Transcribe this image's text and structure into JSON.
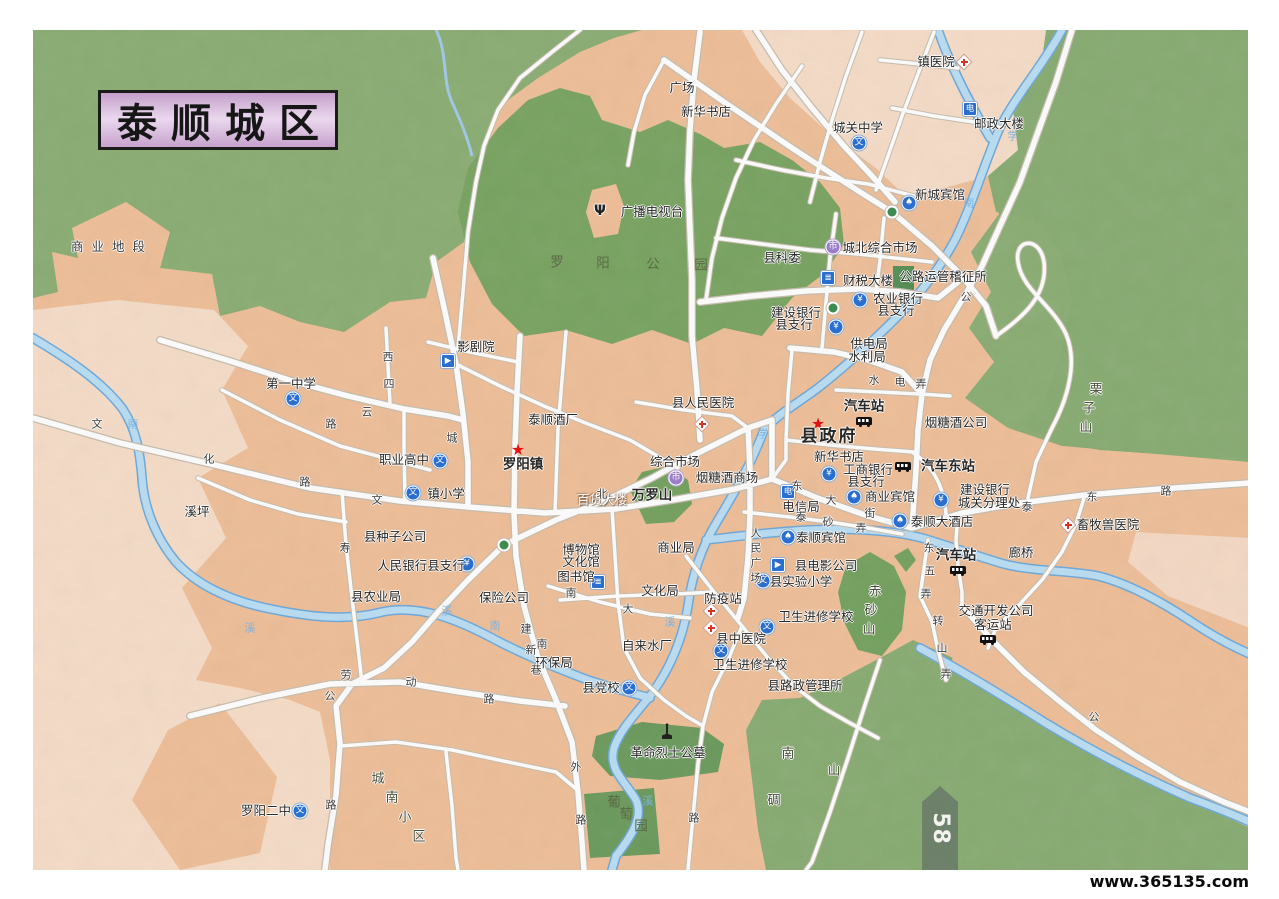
{
  "page": {
    "title": "泰顺城区",
    "page_number": "58",
    "watermark": "www.365135.com"
  },
  "colors": {
    "hills_green": "#87ab6f",
    "park_green": "#74a15c",
    "urban_salmon": "#efbd95",
    "urban_pale": "#f6dcc6",
    "river_blue": "#b8ddf4",
    "river_edge": "#6aa6d8",
    "road_white": "#ffffff",
    "road_casing": "#c6bcab",
    "icon_blue": "#2a6fd0",
    "title_purple": "#d5b3da",
    "star_red": "#e01010"
  },
  "map": {
    "icon_glyphs": {
      "school": "文",
      "bank": "¥",
      "hotel": "♠",
      "market": "市",
      "postal": "电",
      "book": "≣",
      "cinema": "▶",
      "antenna": "Ψ",
      "star": "★"
    },
    "labels": [
      [
        "商业地段",
        112,
        247,
        "a"
      ],
      [
        "广场",
        682,
        88,
        "p"
      ],
      [
        "新华书店",
        706,
        112,
        "p"
      ],
      [
        "镇医院",
        936,
        62,
        "p"
      ],
      [
        "城关中学",
        858,
        128,
        "p"
      ],
      [
        "邮政大楼",
        999,
        124,
        "p"
      ],
      [
        "新城宾馆",
        940,
        195,
        "p"
      ],
      [
        "城北综合市场",
        880,
        248,
        "p"
      ],
      [
        "县科委",
        782,
        258,
        "p"
      ],
      [
        "财税大楼",
        868,
        281,
        "p"
      ],
      [
        "公路运管稽征所",
        943,
        277,
        "p"
      ],
      [
        "农业银行",
        898,
        299,
        "p"
      ],
      [
        "县支行",
        896,
        311,
        "p"
      ],
      [
        "建设银行",
        796,
        313,
        "p"
      ],
      [
        "县支行",
        794,
        325,
        "p"
      ],
      [
        "供电局",
        869,
        344,
        "p"
      ],
      [
        "水利局",
        867,
        357,
        "p"
      ],
      [
        "汽车站",
        864,
        407,
        "b"
      ],
      [
        "县政府",
        829,
        437,
        "B"
      ],
      [
        "新华书店",
        839,
        457,
        "p"
      ],
      [
        "工商银行",
        868,
        470,
        "p"
      ],
      [
        "县支行",
        866,
        482,
        "p"
      ],
      [
        "商业宾馆",
        890,
        497,
        "p"
      ],
      [
        "电信局",
        801,
        507,
        "p"
      ],
      [
        "泰顺大酒店",
        942,
        522,
        "p"
      ],
      [
        "泰顺宾馆",
        821,
        538,
        "p"
      ],
      [
        "汽车东站",
        948,
        467,
        "b"
      ],
      [
        "建设银行",
        985,
        490,
        "p"
      ],
      [
        "城关分理处",
        989,
        503,
        "p"
      ],
      [
        "烟糖酒公司",
        956,
        423,
        "p"
      ],
      [
        "汽车站",
        956,
        556,
        "b"
      ],
      [
        "廊桥",
        1021,
        553,
        "p"
      ],
      [
        "畜牧兽医院",
        1108,
        525,
        "p"
      ],
      [
        "交通开发公司",
        996,
        611,
        "p"
      ],
      [
        "客运站",
        993,
        625,
        "p"
      ],
      [
        "县电影公司",
        826,
        566,
        "p"
      ],
      [
        "县实验小学",
        801,
        582,
        "p"
      ],
      [
        "卫生进修学校",
        816,
        617,
        "p"
      ],
      [
        "防疫站",
        723,
        599,
        "p"
      ],
      [
        "县中医院",
        741,
        639,
        "p"
      ],
      [
        "卫生进修学校",
        750,
        665,
        "p"
      ],
      [
        "县路政管理所",
        805,
        686,
        "p"
      ],
      [
        "县党校",
        601,
        688,
        "p"
      ],
      [
        "环保局",
        554,
        663,
        "p"
      ],
      [
        "自来水厂",
        647,
        646,
        "p"
      ],
      [
        "文化局",
        660,
        591,
        "p"
      ],
      [
        "图书馆",
        576,
        577,
        "p"
      ],
      [
        "博物馆",
        581,
        550,
        "p"
      ],
      [
        "文化馆",
        581,
        562,
        "p"
      ],
      [
        "商业局",
        676,
        548,
        "p"
      ],
      [
        "保险公司",
        504,
        598,
        "p"
      ],
      [
        "县农业局",
        376,
        597,
        "p"
      ],
      [
        "人民银行县支行",
        421,
        566,
        "p"
      ],
      [
        "县种子公司",
        395,
        537,
        "p"
      ],
      [
        "溪坪",
        197,
        512,
        "p"
      ],
      [
        "镇小学",
        446,
        494,
        "p"
      ],
      [
        "职业高中",
        404,
        460,
        "p"
      ],
      [
        "第一中学",
        291,
        384,
        "p"
      ],
      [
        "影剧院",
        476,
        347,
        "p"
      ],
      [
        "泰顺酒厂",
        553,
        420,
        "p"
      ],
      [
        "罗阳镇",
        523,
        465,
        "b"
      ],
      [
        "县人民医院",
        703,
        403,
        "p"
      ],
      [
        "综合市场",
        675,
        462,
        "p"
      ],
      [
        "烟糖酒商场",
        727,
        478,
        "p"
      ],
      [
        "百货大楼",
        602,
        500,
        "w"
      ],
      [
        "革命烈士公墓",
        668,
        753,
        "p"
      ],
      [
        "罗阳二中",
        266,
        811,
        "p"
      ],
      [
        "广播电视台",
        652,
        212,
        "p"
      ],
      [
        "万罗山",
        652,
        496,
        "b"
      ],
      [
        "赤",
        875,
        592,
        "m"
      ],
      [
        "砂",
        871,
        611,
        "m"
      ],
      [
        "山",
        869,
        630,
        "m"
      ],
      [
        "栗",
        1096,
        390,
        "m"
      ],
      [
        "子",
        1089,
        409,
        "m"
      ],
      [
        "山",
        1086,
        428,
        "m"
      ],
      [
        "南",
        788,
        754,
        "m"
      ],
      [
        "山",
        834,
        771,
        "m"
      ],
      [
        "碉",
        774,
        801,
        "m"
      ],
      [
        "城",
        378,
        779,
        "m"
      ],
      [
        "南",
        392,
        798,
        "m"
      ],
      [
        "小",
        405,
        818,
        "m"
      ],
      [
        "区",
        419,
        837,
        "m"
      ],
      [
        "罗",
        557,
        263,
        "g"
      ],
      [
        "阳",
        603,
        264,
        "g"
      ],
      [
        "公",
        653,
        265,
        "g"
      ],
      [
        "园",
        701,
        266,
        "g"
      ],
      [
        "葡",
        614,
        803,
        "g"
      ],
      [
        "萄",
        626,
        815,
        "g"
      ],
      [
        "园",
        641,
        827,
        "g"
      ],
      [
        "文",
        97,
        424,
        "r"
      ],
      [
        "化",
        209,
        459,
        "r"
      ],
      [
        "路",
        305,
        482,
        "r"
      ],
      [
        "西",
        388,
        357,
        "r"
      ],
      [
        "四",
        389,
        384,
        "r"
      ],
      [
        "云",
        367,
        412,
        "r"
      ],
      [
        "路",
        331,
        424,
        "r"
      ],
      [
        "文",
        377,
        500,
        "r"
      ],
      [
        "寿",
        345,
        548,
        "r"
      ],
      [
        "劳",
        346,
        675,
        "r"
      ],
      [
        "动",
        411,
        682,
        "r"
      ],
      [
        "路",
        489,
        699,
        "r"
      ],
      [
        "公",
        330,
        696,
        "r"
      ],
      [
        "路",
        331,
        805,
        "r"
      ],
      [
        "外",
        576,
        767,
        "r"
      ],
      [
        "路",
        581,
        820,
        "r"
      ],
      [
        "南",
        542,
        644,
        "r"
      ],
      [
        "建",
        526,
        629,
        "r"
      ],
      [
        "新",
        531,
        650,
        "r"
      ],
      [
        "巷",
        536,
        670,
        "r"
      ],
      [
        "南",
        571,
        593,
        "r"
      ],
      [
        "大",
        628,
        609,
        "r"
      ],
      [
        "北",
        602,
        494,
        "r"
      ],
      [
        "东",
        797,
        486,
        "r"
      ],
      [
        "大",
        831,
        500,
        "r"
      ],
      [
        "街",
        870,
        513,
        "r"
      ],
      [
        "泰",
        801,
        517,
        "r"
      ],
      [
        "砂",
        828,
        522,
        "r"
      ],
      [
        "弄",
        861,
        528,
        "r"
      ],
      [
        "人",
        756,
        533,
        "r"
      ],
      [
        "民",
        756,
        548,
        "r"
      ],
      [
        "广",
        756,
        563,
        "r"
      ],
      [
        "场",
        756,
        578,
        "r"
      ],
      [
        "东",
        929,
        548,
        "r"
      ],
      [
        "五",
        930,
        571,
        "r"
      ],
      [
        "弄",
        926,
        594,
        "r"
      ],
      [
        "转",
        938,
        621,
        "r"
      ],
      [
        "山",
        942,
        648,
        "r"
      ],
      [
        "弄",
        946,
        674,
        "r"
      ],
      [
        "泰",
        1027,
        507,
        "r"
      ],
      [
        "东",
        1092,
        497,
        "r"
      ],
      [
        "路",
        1166,
        491,
        "r"
      ],
      [
        "公",
        966,
        297,
        "r"
      ],
      [
        "水",
        874,
        380,
        "r"
      ],
      [
        "电",
        900,
        382,
        "r"
      ],
      [
        "弄",
        921,
        384,
        "r"
      ],
      [
        "城",
        452,
        438,
        "r"
      ],
      [
        "公",
        1094,
        717,
        "r"
      ],
      [
        "路",
        694,
        818,
        "r"
      ],
      [
        "南",
        133,
        424,
        "v"
      ],
      [
        "溪",
        250,
        628,
        "v"
      ],
      [
        "溪",
        447,
        611,
        "v"
      ],
      [
        "南",
        495,
        626,
        "v"
      ],
      [
        "溪",
        670,
        622,
        "v"
      ],
      [
        "溪",
        648,
        801,
        "v"
      ],
      [
        "学",
        763,
        434,
        "v"
      ],
      [
        "南",
        969,
        203,
        "v"
      ],
      [
        "学",
        1013,
        136,
        "v"
      ]
    ],
    "icons": [
      [
        "star",
        818,
        424
      ],
      [
        "star",
        518,
        450
      ],
      [
        "school",
        859,
        143
      ],
      [
        "school",
        293,
        399
      ],
      [
        "school",
        440,
        461
      ],
      [
        "school",
        413,
        493
      ],
      [
        "school",
        300,
        811
      ],
      [
        "school",
        629,
        688
      ],
      [
        "school",
        767,
        627
      ],
      [
        "school",
        721,
        651
      ],
      [
        "school",
        763,
        581
      ],
      [
        "hospital",
        964,
        62
      ],
      [
        "hospital",
        702,
        424
      ],
      [
        "hospital",
        711,
        611
      ],
      [
        "hospital",
        711,
        628
      ],
      [
        "hospital",
        1068,
        525
      ],
      [
        "bank",
        467,
        564
      ],
      [
        "bank",
        860,
        300
      ],
      [
        "bank",
        836,
        327
      ],
      [
        "bank",
        829,
        474
      ],
      [
        "bank",
        941,
        500
      ],
      [
        "hotel",
        909,
        203
      ],
      [
        "hotel",
        854,
        497
      ],
      [
        "hotel",
        900,
        521
      ],
      [
        "hotel",
        788,
        537
      ],
      [
        "market",
        833,
        247
      ],
      [
        "market",
        676,
        478
      ],
      [
        "bus",
        864,
        421
      ],
      [
        "bus",
        903,
        466
      ],
      [
        "bus",
        958,
        570
      ],
      [
        "bus",
        988,
        639
      ],
      [
        "postal",
        970,
        109
      ],
      [
        "postal",
        788,
        492
      ],
      [
        "book",
        828,
        278
      ],
      [
        "book",
        598,
        582
      ],
      [
        "cinema",
        448,
        361
      ],
      [
        "cinema",
        778,
        565
      ],
      [
        "monument",
        667,
        731
      ],
      [
        "antenna",
        600,
        211
      ],
      [
        "roundabout",
        892,
        212
      ],
      [
        "roundabout",
        504,
        545
      ],
      [
        "roundabout",
        833,
        308
      ]
    ]
  }
}
